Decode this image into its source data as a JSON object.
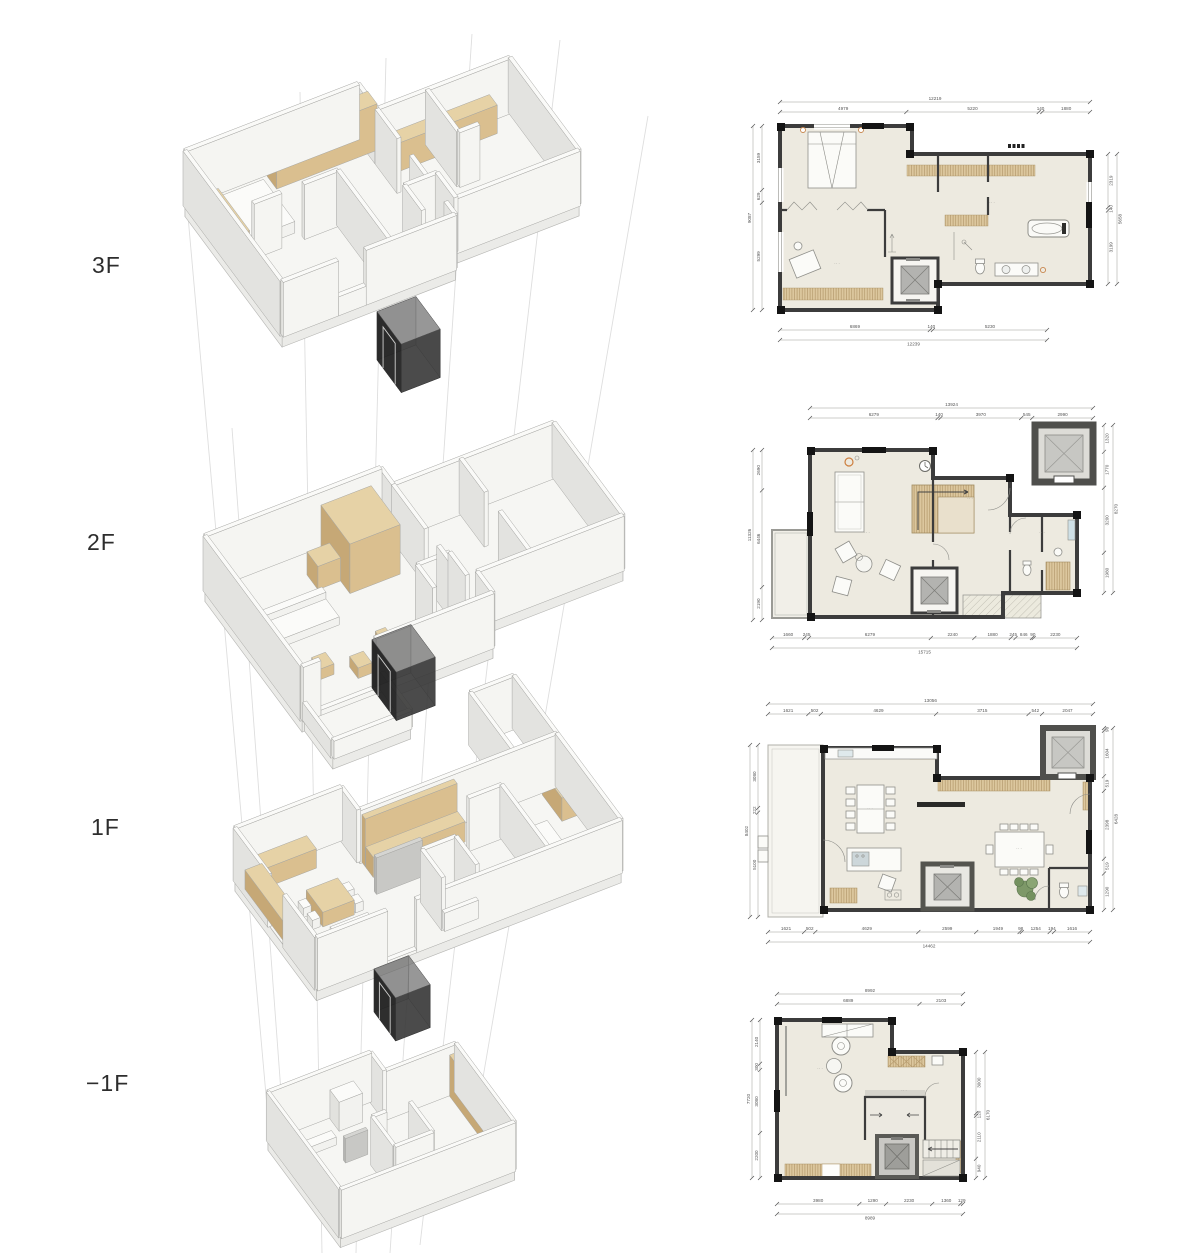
{
  "labels": {
    "f3": "3F",
    "f2": "2F",
    "f1": "1F",
    "fm1": "−1F"
  },
  "colors": {
    "wall_dark": "#3c3c3c",
    "corner_black": "#141414",
    "floor_cream": "#edeae0",
    "wood": "#d9c096",
    "wood_line": "#b59a6d",
    "elevator_gray": "#b3b3b0",
    "shaft_dark": "#4f4f4c",
    "iso_white": "#f5f5f2",
    "iso_side": "#e3e3e0",
    "iso_wood": "#dabf8f",
    "glass_cube": "#1f1f1f",
    "guide_line": "#dedede",
    "accent_orange": "#c8874f",
    "plant_green": "#74925e",
    "dim_text": "#555555"
  },
  "plans": {
    "p3f": {
      "top": [
        "4979",
        "5220",
        "140",
        "1880"
      ],
      "top_total": "12219",
      "bottom": [
        "6869",
        "140",
        "5230"
      ],
      "bottom_total": "12239",
      "left": [
        "3159",
        "629",
        "5299"
      ],
      "left_total": "9087",
      "right": [
        "2319",
        "140",
        "3199"
      ],
      "right_total": "5658"
    },
    "p2f": {
      "top": [
        "6279",
        "140",
        "3970",
        "545",
        "2990"
      ],
      "top_total": "13924",
      "bottom": [
        "1660",
        "245",
        "6279",
        "2240",
        "1880",
        "245",
        "846",
        "90",
        "2230"
      ],
      "bottom_total": "15715",
      "left": [
        "2690",
        "6446",
        "2190"
      ],
      "left_total": "11326",
      "right": [
        "1320",
        "1770",
        "3200",
        "1980"
      ],
      "right_total": "8270"
    },
    "p1f": {
      "top": [
        "1621",
        "502",
        "4629",
        "3715",
        "542",
        "2047"
      ],
      "top_total": "13056",
      "bottom": [
        "1621",
        "502",
        "4629",
        "2599",
        "1949",
        "98",
        "1254",
        "194",
        "1616"
      ],
      "bottom_total": "14462",
      "left": [
        "3080",
        "222",
        "5100"
      ],
      "left_total": "8402",
      "right": [
        "98",
        "1604",
        "519",
        "2398",
        "519",
        "1290"
      ],
      "right_total": "6428"
    },
    "pm1f": {
      "top": [
        "6889",
        "2103"
      ],
      "top_total": "8992",
      "bottom": [
        "3980",
        "1290",
        "2230",
        "1360",
        "129"
      ],
      "bottom_total": "8989",
      "left": [
        "2140",
        "300",
        "3080",
        "2200"
      ],
      "left_total": "7720",
      "right": [
        "3000",
        "120",
        "2110",
        "940"
      ],
      "right_total": "6170"
    }
  },
  "misc": {
    "label_mark": "·· ·"
  }
}
